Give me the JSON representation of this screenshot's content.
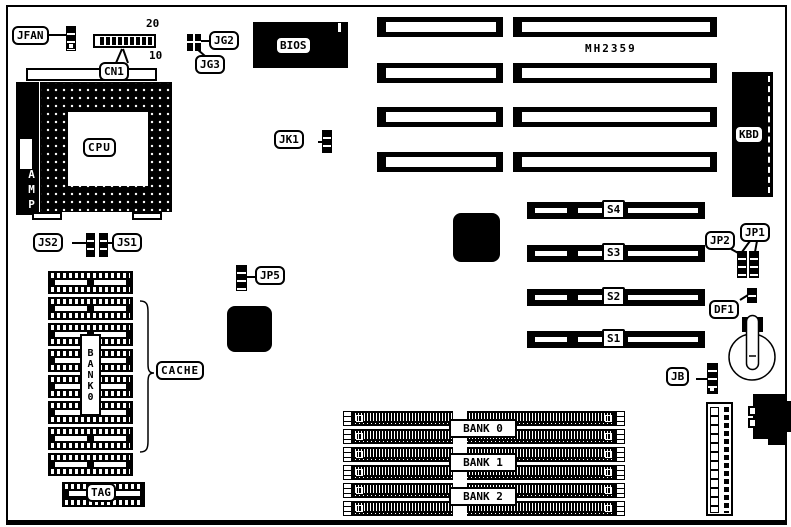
{
  "board": {
    "model": "MH2359",
    "colors": {
      "ink": "#000000",
      "paper": "#ffffff"
    }
  },
  "labels": {
    "jfan": "JFAN",
    "cn1": "CN1",
    "cn1_pin20": "20",
    "cn1_pin10": "10",
    "jg2": "JG2",
    "jg3": "JG3",
    "bios": "BIOS",
    "kbd": "KBD",
    "cpu": "CPU",
    "amp": "AMP",
    "jk1": "JK1",
    "js2": "JS2",
    "js1": "JS1",
    "jp5": "JP5",
    "cache": "CACHE",
    "cache_bank": "BANK0",
    "tag": "TAG",
    "s4": "S4",
    "s3": "S3",
    "s2": "S2",
    "s1": "S1",
    "jp2": "JP2",
    "jp1": "JP1",
    "df1": "DF1",
    "jb": "JB",
    "bank0": "BANK 0",
    "bank1": "BANK 1",
    "bank2": "BANK 2"
  }
}
